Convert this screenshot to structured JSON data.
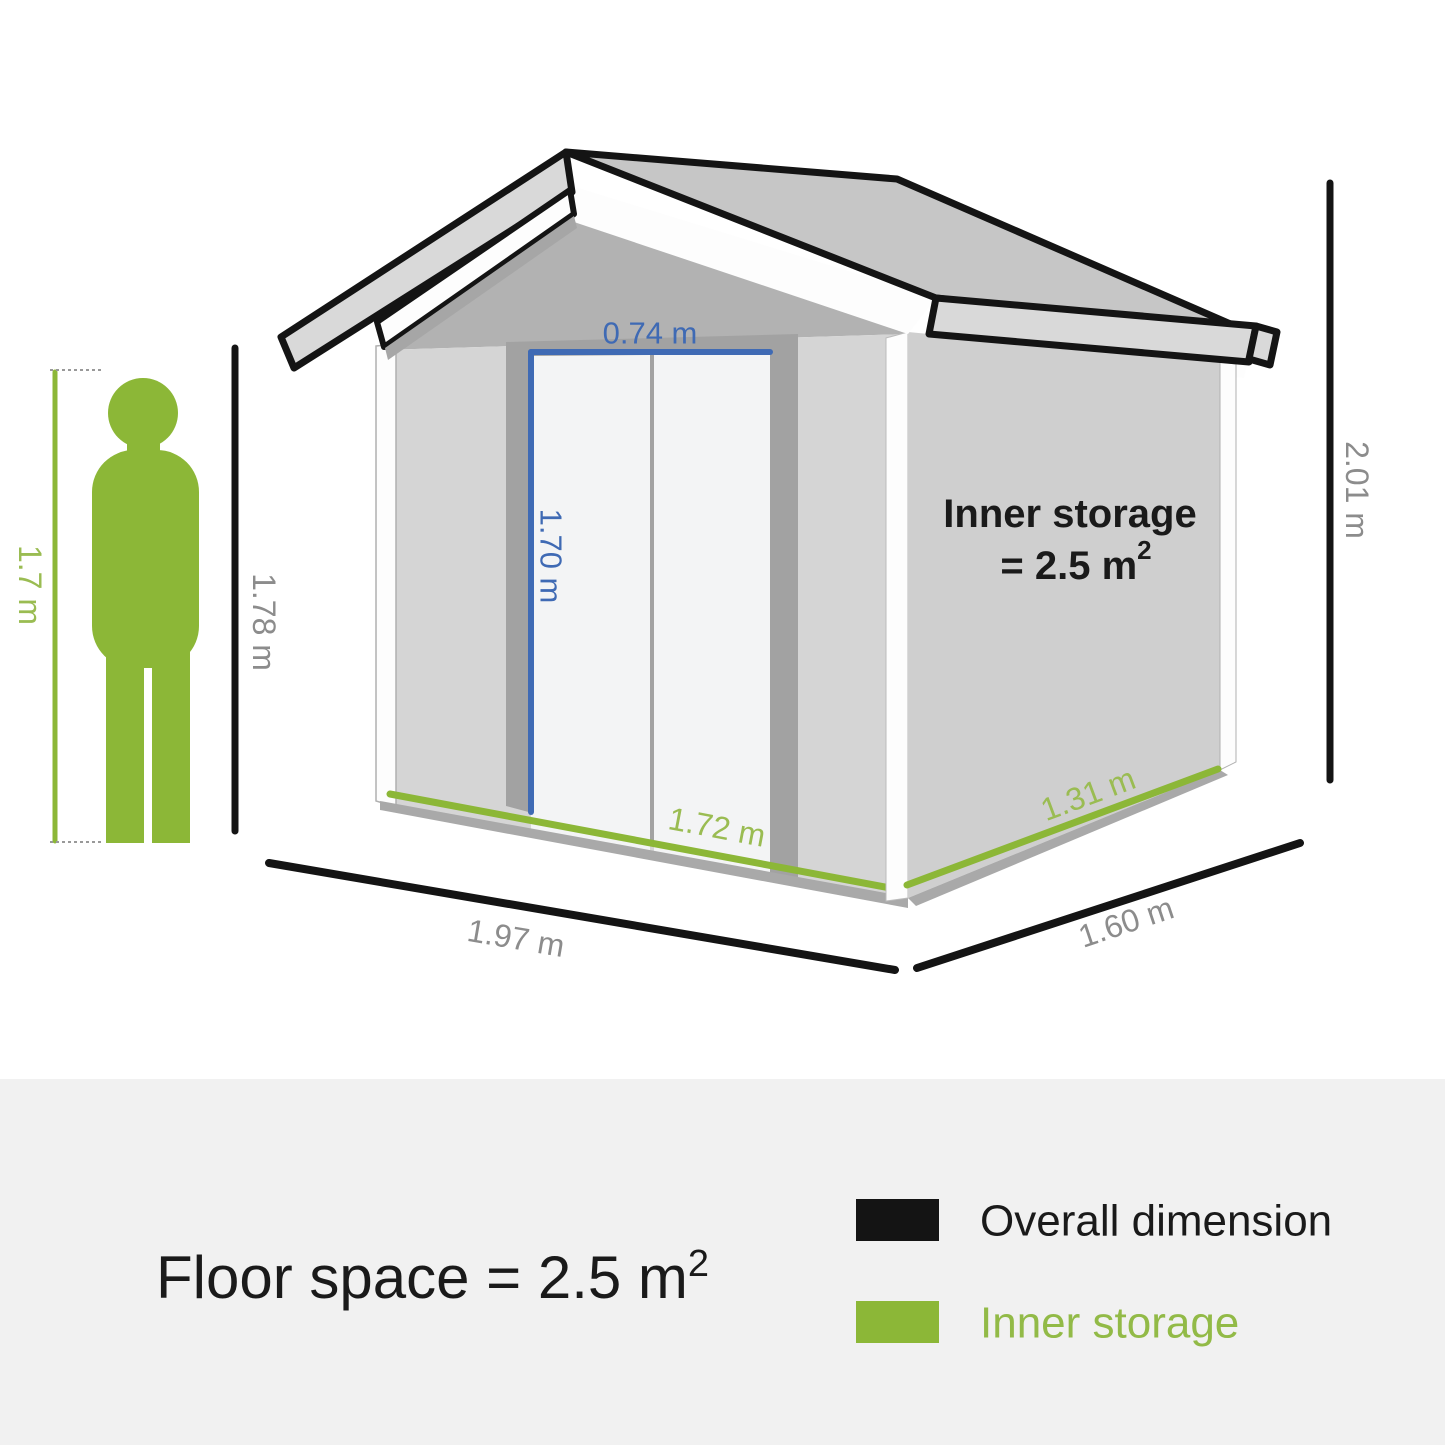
{
  "diagram": {
    "type": "product-dimension-diagram",
    "subject": "garden storage shed with human figure for scale",
    "labels": {
      "person_height": "1.7 m",
      "front_height": "1.78 m",
      "door_width": "0.74 m",
      "door_height": "1.70 m",
      "inner_front": "1.72 m",
      "inner_side": "1.31 m",
      "total_height": "2.01 m",
      "overall_width": "1.97 m",
      "overall_depth": "1.60 m"
    },
    "shed": {
      "inner_storage_title": "Inner storage",
      "inner_storage_value_prefix": "= 2.5 m",
      "inner_storage_exponent": "2"
    }
  },
  "footer": {
    "floor_space_prefix": "Floor space = 2.5 m",
    "floor_space_exponent": "2",
    "legend": [
      {
        "label": "Overall dimension",
        "color": "#141414"
      },
      {
        "label": "Inner storage",
        "color": "#8cb737"
      }
    ]
  },
  "colors": {
    "accent_green": "#8cb737",
    "accent_green_text": "#9abc52",
    "accent_blue": "#3f6ab4",
    "dimension_gray": "#8c8c8c",
    "line_black": "#141414",
    "footer_background": "#f1f1f1"
  }
}
